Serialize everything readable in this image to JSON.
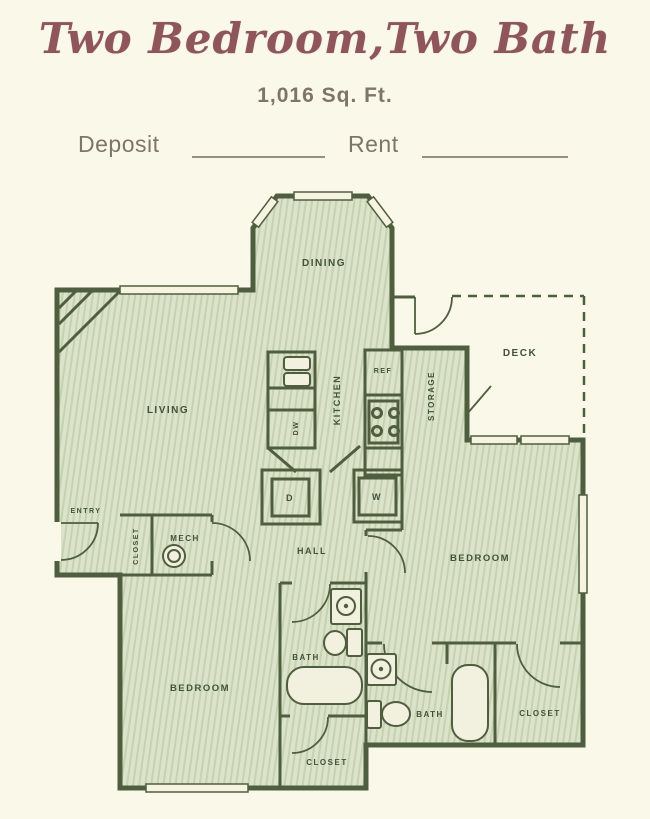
{
  "header": {
    "title": "Two Bedroom,Two Bath",
    "area": "1,016 Sq. Ft.",
    "deposit_label": "Deposit",
    "rent_label": "Rent"
  },
  "plan": {
    "labels": {
      "dining": "DINING",
      "living": "LIVING",
      "kitchen": "KITCHEN",
      "storage": "STORAGE",
      "deck": "DECK",
      "entry": "ENTRY",
      "entry_closet": "CLOSET",
      "mech": "MECH",
      "hall": "HALL",
      "bedroom_right": "BEDROOM",
      "bedroom_left": "BEDROOM",
      "bath_main": "BATH",
      "bath_second": "BATH",
      "closet_bottom": "CLOSET",
      "closet_right": "CLOSET",
      "dishwasher": "DW",
      "refrigerator": "REF",
      "dryer": "D",
      "washer": "W"
    }
  },
  "colors": {
    "background": "#faf8e9",
    "wall": "#4f5e3e",
    "room_fill": "#dce3cb",
    "title_text": "#8e555b",
    "muted_text": "#7e7566",
    "label_text": "#42523a"
  }
}
